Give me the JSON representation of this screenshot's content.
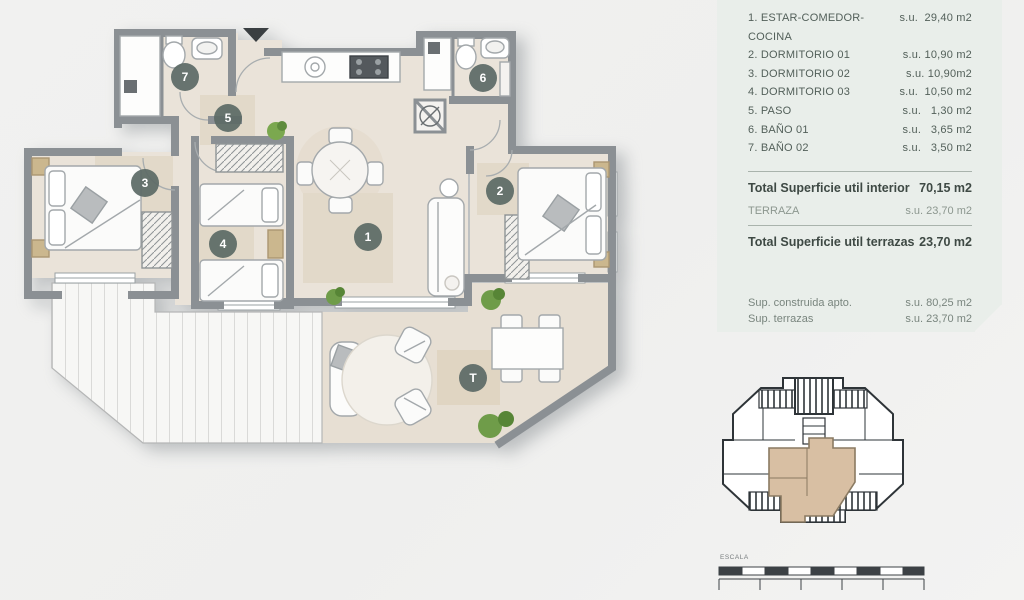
{
  "panel": {
    "rooms": [
      {
        "label": "1. ESTAR-COMEDOR-COCINA",
        "value": "s.u.  29,40 m2"
      },
      {
        "label": "2. DORMITORIO 01",
        "value": "s.u. 10,90 m2"
      },
      {
        "label": "3. DORMITORIO 02",
        "value": "s.u. 10,90m2"
      },
      {
        "label": "4. DORMITORIO 03",
        "value": "s.u.  10,50 m2"
      },
      {
        "label": "5. PASO",
        "value": "s.u.   1,30 m2"
      },
      {
        "label": "6. BAÑO 01",
        "value": "s.u.   3,65 m2"
      },
      {
        "label": "7. BAÑO 02",
        "value": "s.u.   3,50 m2"
      }
    ],
    "total_interior": {
      "label": "Total Superficie util interior",
      "value": "70,15 m2"
    },
    "terraza": {
      "label": "TERRAZA",
      "value": "s.u. 23,70 m2"
    },
    "total_terrazas": {
      "label": "Total Superficie util terrazas",
      "value": "23,70 m2"
    },
    "sup_construida": {
      "label": "Sup. construida apto.",
      "value": "s.u. 80,25 m2"
    },
    "sup_terrazas": {
      "label": "Sup. terrazas",
      "value": "s.u. 23,70 m2"
    },
    "total_construida": {
      "label": "TOTAL CONSTRUIDA",
      "value": "103,95 m2"
    }
  },
  "plan": {
    "room_labels": [
      "1",
      "2",
      "3",
      "4",
      "5",
      "6",
      "7"
    ],
    "terrace_label": "T"
  },
  "scale": {
    "label": "ESCALA"
  },
  "colors": {
    "wall": "#8b9094",
    "floor": "#eae3d9",
    "rug": "#e1d8c8",
    "deck": "#f7f7f5",
    "panel_bg": "#e9eeea",
    "panel_text": "#47524d",
    "accent_total": "#c6936a",
    "room_badge": "#5d6a66",
    "keyplan_unit": "#d8bfa3",
    "plant_green": "#76a24e",
    "page_bg": "#f0efee"
  }
}
